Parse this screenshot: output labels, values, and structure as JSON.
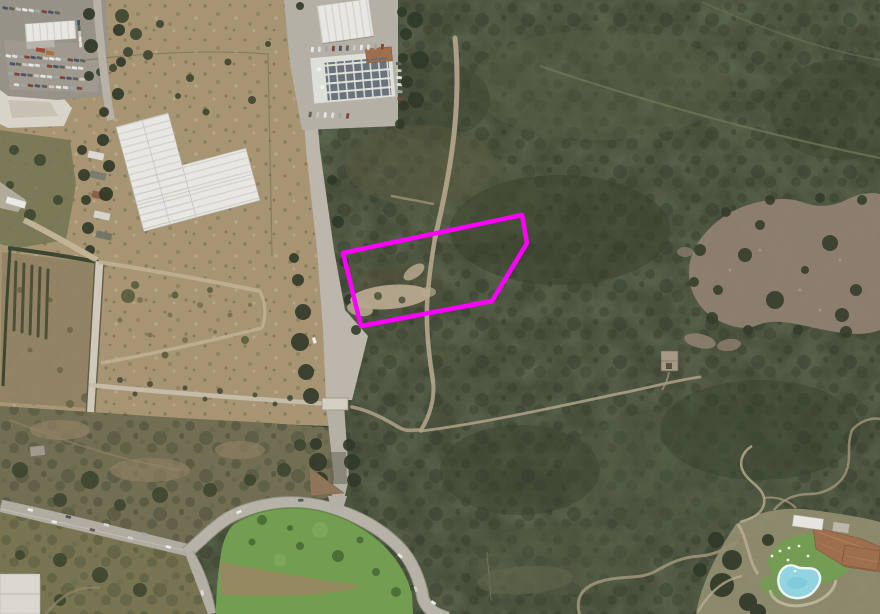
{
  "map": {
    "type": "satellite-aerial-imagery",
    "canvas": {
      "width": 880,
      "height": 614
    },
    "annotation": {
      "parcel_outline": {
        "color": "#ff00ff",
        "stroke_width": 4.5,
        "points_str": "343,253 522,215 527,243 492,301 361,326",
        "points": [
          [
            343,
            253
          ],
          [
            522,
            215
          ],
          [
            527,
            243
          ],
          [
            492,
            301
          ],
          [
            361,
            326
          ]
        ]
      }
    },
    "palette": {
      "scrub_dark_green": "#454d3a",
      "dirt_tan": "#a3906f",
      "road_gray": "#b9b3a8",
      "highway_gray": "#aca89d",
      "lawn_green": "#6e9a4e",
      "pool_blue": "#8ed2e0",
      "roof_terracotta": "#9a6a4b",
      "warehouse_white": "#e7e6e1"
    },
    "features": [
      "scrapyard-with-cars",
      "l-shaped-white-warehouse",
      "industrial-buildings-with-solar-roof",
      "main-access-road",
      "magenta-parcel-boundary",
      "dirt-clearing-inside-parcel",
      "maquis-scrubland",
      "open-brown-field",
      "small-ruin",
      "highway-interchange",
      "grass-island",
      "resort-with-swimming-pool"
    ]
  }
}
